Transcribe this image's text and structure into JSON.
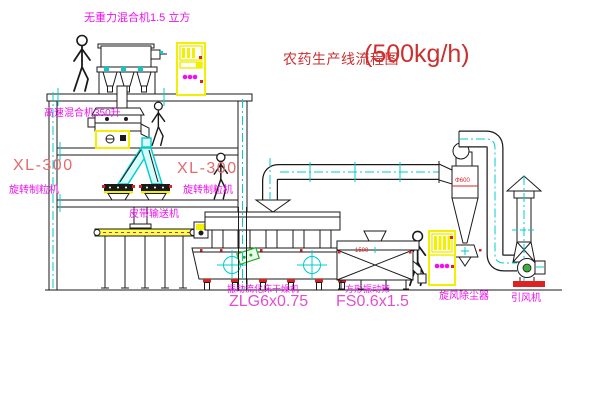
{
  "title": {
    "text": "农药生产线流程图",
    "capacity": "(500kg/h)"
  },
  "labels": {
    "top_mixer": "无重力混合机1.5 立方",
    "high_speed_mixer": "高速混合机350升",
    "granulator_left_model": "XL-300",
    "granulator_left_name": "旋转制粒机",
    "granulator_right_model": "XL-300",
    "granulator_right_name": "旋转制粒机",
    "belt_conveyor": "皮带输送机",
    "fluid_bed_dryer": "振动流化床干燥机",
    "fluid_bed_dryer_model": "ZLG6x0.75",
    "vibrating_screen": "方形振动筛",
    "vibrating_screen_model": "FS0.6x1.5",
    "cyclone": "旋风除尘器",
    "induced_draft_fan": "引风机",
    "cyclone_dim": "Φ600",
    "screen_dim": "1500"
  },
  "colors": {
    "line": "#1a1a1a",
    "magenta": "#ee10ee",
    "pink": "#e24fd0",
    "red": "#cc2f2f",
    "xlred": "#e46a6a",
    "reddot": "#dd2222",
    "cyan": "#00cccc",
    "yellow": "#f0f000",
    "green": "#2aa82a"
  }
}
